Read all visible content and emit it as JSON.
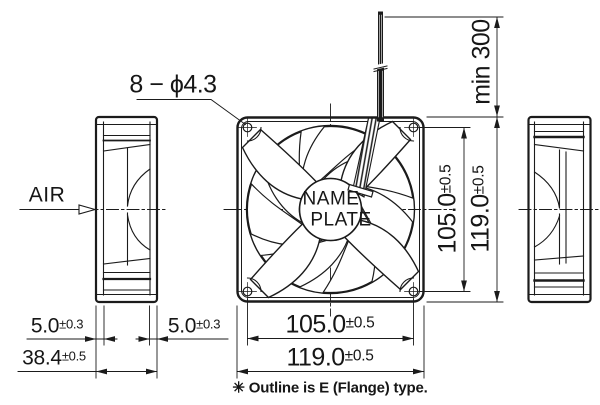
{
  "drawing": {
    "air_label": "AIR",
    "holes_callout": "8 − ϕ4.3",
    "lead_wire_min_length": "min 300",
    "nameplate": {
      "line1": "NAME",
      "line2": "PLATE"
    },
    "footnote": "✳ Outline is E (Flange) type.",
    "dimensions": {
      "mount_hole_pitch_vertical": {
        "value": "105.0",
        "tolerance": "±0.5"
      },
      "frame_height": {
        "value": "119.0",
        "tolerance": "±0.5"
      },
      "mount_hole_pitch_horizontal": {
        "value": "105.0",
        "tolerance": "±0.5"
      },
      "frame_width": {
        "value": "119.0",
        "tolerance": "±0.5"
      },
      "flange_depth_left": {
        "value": "5.0",
        "tolerance": "±0.3"
      },
      "flange_depth_right": {
        "value": "5.0",
        "tolerance": "±0.3"
      },
      "frame_depth": {
        "value": "38.4",
        "tolerance": "±0.5"
      }
    },
    "colors": {
      "line": "#1b1b1b",
      "background": "#ffffff"
    }
  }
}
